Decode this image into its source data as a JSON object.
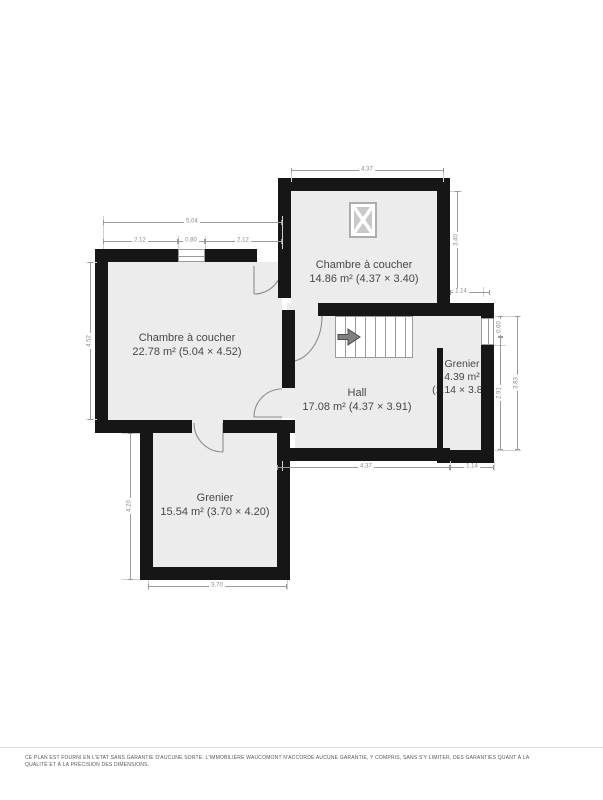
{
  "plan": {
    "rooms": [
      {
        "name": "Chambre à coucher",
        "area": "14.86 m² (4.37 × 3.40)"
      },
      {
        "name": "Chambre à coucher",
        "area": "22.78 m² (5.04 × 4.52)"
      },
      {
        "name": "Hall",
        "area": "17.08 m² (4.37 × 3.91)"
      },
      {
        "name": "Grenier",
        "area": "4.39 m²",
        "dims": "(1.14 × 3.85)"
      },
      {
        "name": "Grenier",
        "area": "15.54 m² (3.70 × 4.20)"
      }
    ],
    "dims": {
      "top_width": "4.37",
      "bed2_width": "5.04",
      "bed2_seg1": "2.12",
      "bed2_window": "0.80",
      "bed2_seg2": "2.12",
      "bed2_height": "4.52",
      "grenier2_height": "4.20",
      "grenier2_width": "3.70",
      "hall_width": "4.37",
      "grenier1_width_bottom": "1.14",
      "bed1_height": "3.40",
      "grenier1_width_top": "1.14",
      "grenier1_win": "0.60",
      "grenier1_inner": "2.91",
      "grenier1_outer": "3.83"
    },
    "disclaimer_line1": "CE PLAN EST FOURNI EN L'ETAT SANS GARANTIE D'AUCUNE SORTE. L'IMMOBILIÈRE WAUCOMONT N'ACCORDE AUCUNE GARANTIE, Y COMPRIS, SANS S'Y LIMITER, DES GARANTIES QUANT À LA",
    "disclaimer_line2": "QUALITÉ ET À LA PRÉCISION DES DIMENSIONS."
  },
  "colors": {
    "wall": "#161616",
    "room_fill": "#ececec",
    "dim_text": "#8a8a8a",
    "label_text": "#474747"
  }
}
